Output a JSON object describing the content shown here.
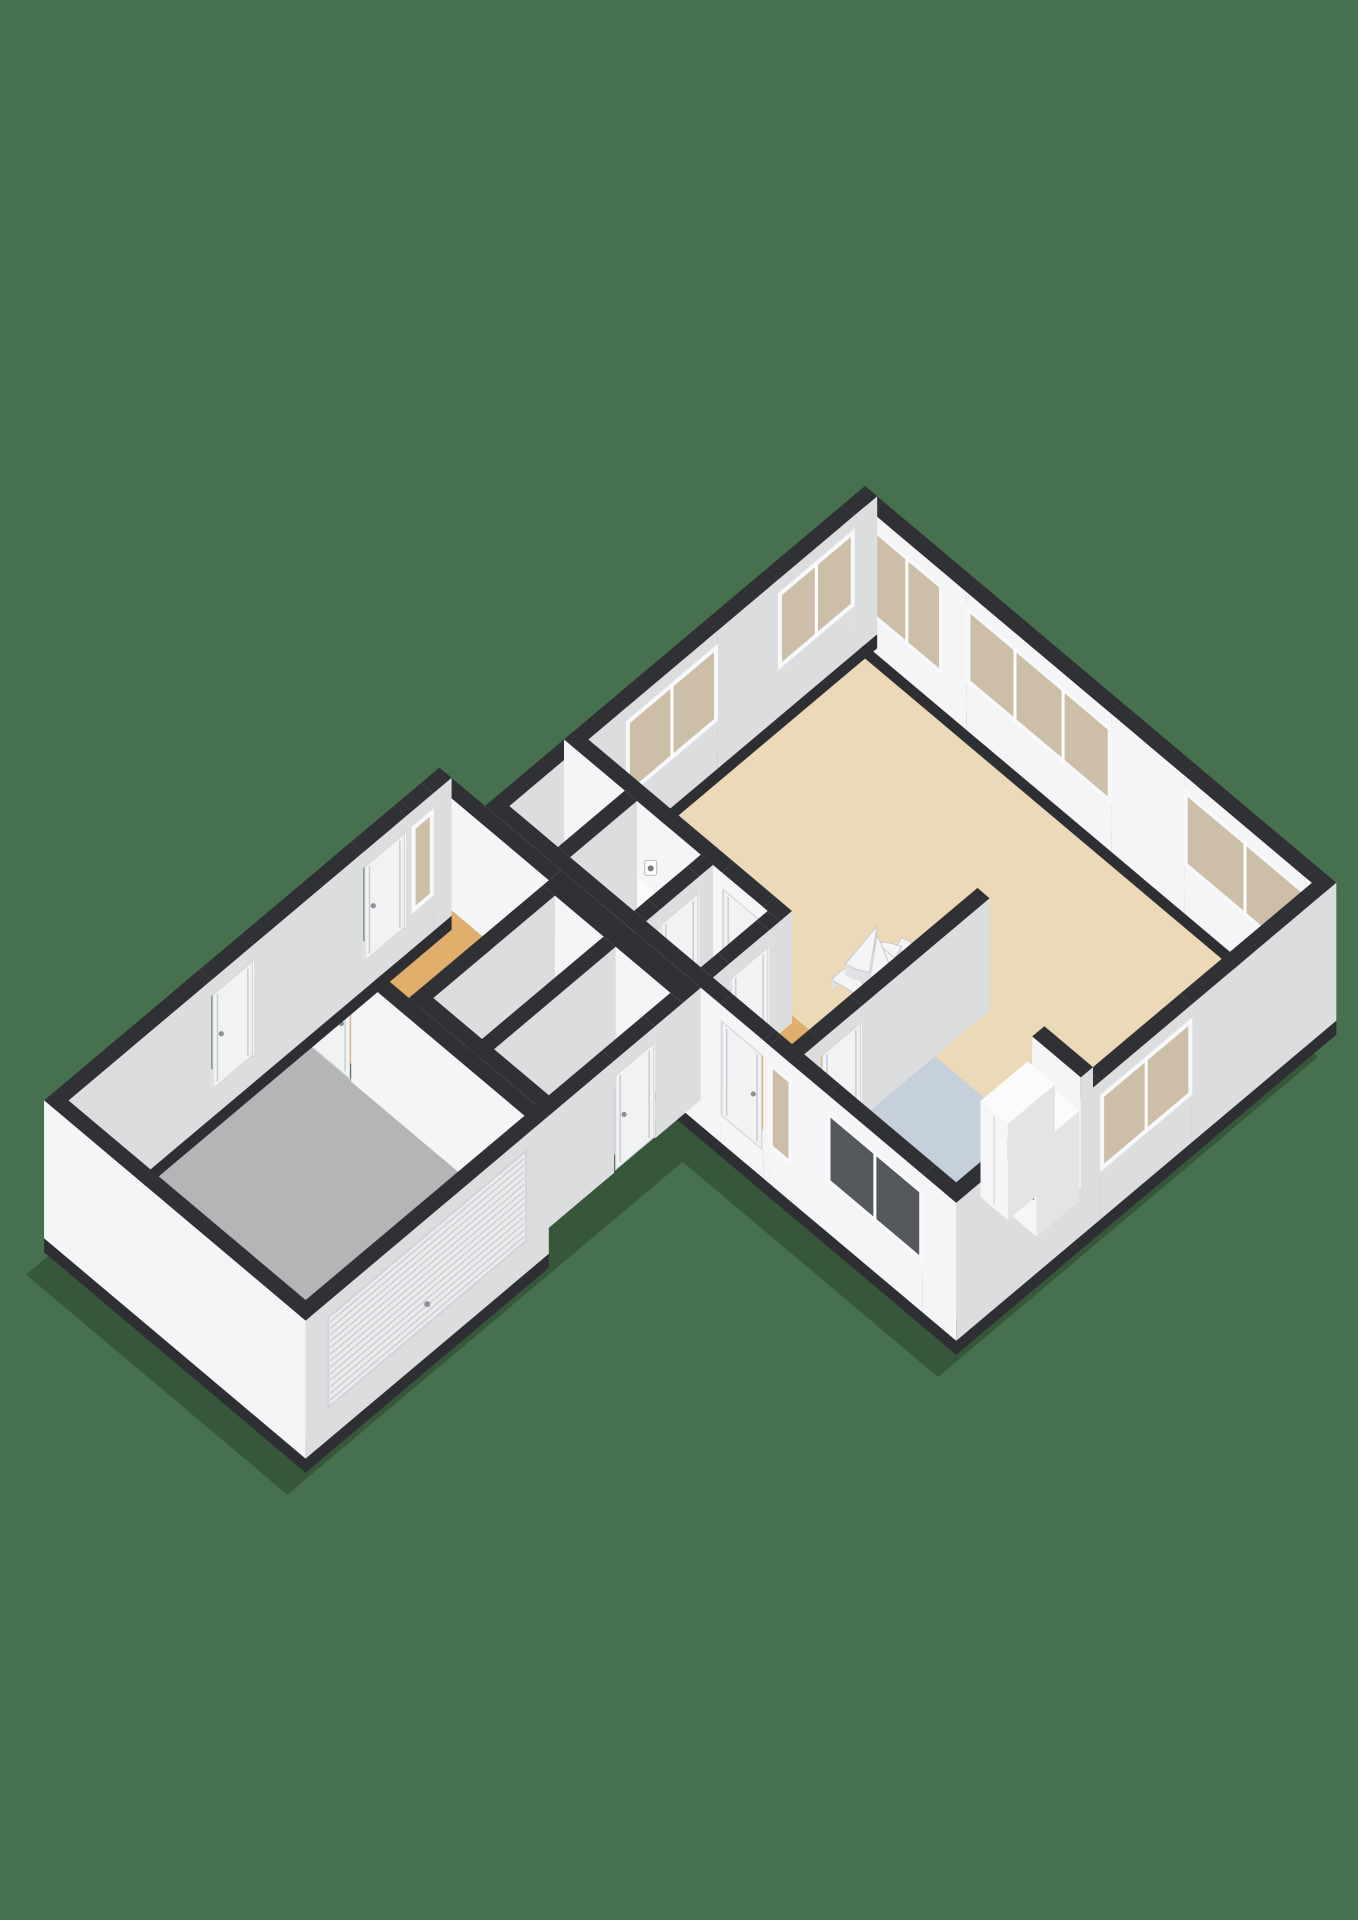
{
  "scene": {
    "title": "3d-floorplan-ground-floor",
    "background": "#47704E",
    "canvas": {
      "width": 1358,
      "height": 1920
    },
    "projection": {
      "ax": 0.76,
      "ay": 0.64,
      "ox": 865,
      "oy": 598,
      "wallHeight": 112,
      "extBase": -26,
      "plinthBase": -40
    },
    "colors": {
      "wallTop": "#303134",
      "faceV": "#F5F5F7",
      "faceU": "#DCDDDF",
      "plinth": "#2E2F33",
      "sillTop": "#E8E9EB",
      "glassTan": "#CDBFA7",
      "glassDark": "#55585D",
      "frame": "#F7F8FA",
      "leaf": "#F1F2F4",
      "leafSeam": "#C8C9CC",
      "handle": "#8E9094",
      "rollerFill": "#E9EAEC",
      "rollerLine": "#C6C7CA",
      "stepFill": "#F4F4F6",
      "stepEdge": "#C9CACD",
      "riser": "#E0E1E4",
      "boxTop": "#FBFBFC",
      "boxFaceV": "#F6F6F8",
      "boxFaceU": "#E3E4E6",
      "darkNiche": "#3A3C40",
      "socket": "#777B80",
      "shadow": "rgba(15,30,18,0.30)"
    },
    "floors": [
      {
        "name": "floor-living-room",
        "rect": [
          10,
          10,
          610,
          388
        ],
        "color": "#EBD9B7"
      },
      {
        "name": "floor-kitchen",
        "rect": [
          396,
          312,
          612,
          492
        ],
        "color": "#C6D0DC"
      },
      {
        "name": "floor-hall-lower",
        "rect": [
          10,
          374,
          396,
          498
        ],
        "color": "#E1AF6C"
      },
      {
        "name": "floor-boiler-room",
        "rect": [
          96,
          396,
          180,
          486
        ],
        "color": "#CDCED0"
      },
      {
        "name": "floor-utility-room",
        "rect": [
          196,
          396,
          268,
          486
        ],
        "color": "#CDCED0"
      },
      {
        "name": "floor-entry-hall",
        "rect": [
          -48,
          514,
          104,
          702
        ],
        "color": "#E1AF6C"
      },
      {
        "name": "floor-storage-room",
        "rect": [
          114,
          522,
          182,
          688
        ],
        "color": "#CDCED0"
      },
      {
        "name": "floor-toilet-room",
        "rect": [
          194,
          522,
          270,
          688
        ],
        "color": "#CDCED0"
      },
      {
        "name": "floor-garage",
        "rect": [
          -46,
          714,
          272,
          1008
        ],
        "color": "#B4B5B7"
      }
    ],
    "walls": [
      {
        "name": "wall-ne-living",
        "rect": [
          0,
          0,
          620,
          16
        ],
        "ext": true,
        "features": [
          {
            "type": "window",
            "a": 24,
            "b": 118,
            "sill": 8,
            "head": 98,
            "panes": 2,
            "glass": "tan"
          },
          {
            "type": "window",
            "a": 150,
            "b": 340,
            "sill": 22,
            "head": 98,
            "panes": 3,
            "glass": "tan"
          },
          {
            "type": "window",
            "a": 436,
            "b": 596,
            "sill": 22,
            "head": 98,
            "panes": 2,
            "glass": "tan"
          }
        ]
      },
      {
        "name": "wall-nw-living",
        "rect": [
          0,
          0,
          16,
          500
        ],
        "ext": true,
        "features": [
          {
            "type": "window",
            "a": 30,
            "b": 130,
            "sill": 22,
            "head": 98,
            "panes": 2,
            "glass": "tan"
          },
          {
            "type": "window",
            "a": 210,
            "b": 330,
            "sill": 22,
            "head": 98,
            "panes": 2,
            "glass": "tan"
          }
        ]
      },
      {
        "name": "wall-east-end",
        "rect": [
          604,
          0,
          620,
          500
        ],
        "ext": true,
        "features": [
          {
            "type": "window",
            "a": 190,
            "b": 310,
            "sill": 22,
            "head": 98,
            "panes": 2,
            "glass": "tan"
          }
        ]
      },
      {
        "name": "wall-kitchen-ne",
        "rect": [
          540,
          304,
          604,
          320
        ],
        "features": []
      },
      {
        "name": "wall-stair-kitchen-west",
        "rect": [
          388,
          240,
          404,
          500
        ],
        "features": [
          {
            "type": "door",
            "a": 408,
            "b": 462
          }
        ]
      },
      {
        "name": "wall-living-hall",
        "rect": [
          0,
          380,
          284,
          396
        ],
        "features": [
          {
            "type": "socket",
            "a": 114,
            "z": 56
          },
          {
            "type": "door",
            "a": 208,
            "b": 262
          }
        ]
      },
      {
        "name": "wall-boiler-west",
        "rect": [
          80,
          396,
          96,
          484
        ],
        "features": []
      },
      {
        "name": "wall-boiler-mid",
        "rect": [
          180,
          396,
          196,
          484
        ],
        "features": [
          {
            "type": "door",
            "a": 414,
            "b": 466
          }
        ]
      },
      {
        "name": "wall-utility-east",
        "rect": [
          268,
          396,
          284,
          484
        ],
        "features": [
          {
            "type": "door",
            "a": 410,
            "b": 462
          }
        ]
      },
      {
        "name": "wall-se-main",
        "rect": [
          0,
          484,
          620,
          500
        ],
        "ext": true,
        "features": [
          {
            "type": "door",
            "a": 310,
            "b": 366
          },
          {
            "type": "window",
            "a": 374,
            "b": 404,
            "sill": 10,
            "head": 96,
            "panes": 1,
            "glass": "tan"
          },
          {
            "type": "window",
            "a": 450,
            "b": 576,
            "sill": 24,
            "head": 96,
            "panes": 2,
            "glass": "dark"
          }
        ]
      },
      {
        "name": "wall-annex-ne",
        "rect": [
          -60,
          500,
          100,
          516
        ],
        "features": []
      },
      {
        "name": "wall-rooms-ne",
        "rect": [
          100,
          500,
          284,
          524
        ],
        "features": []
      },
      {
        "name": "wall-rooms-nw",
        "rect": [
          100,
          524,
          116,
          700
        ],
        "features": []
      },
      {
        "name": "wall-rooms-mid",
        "rect": [
          180,
          524,
          196,
          700
        ],
        "features": []
      },
      {
        "name": "wall-rooms-east",
        "rect": [
          268,
          524,
          284,
          700
        ],
        "features": [
          {
            "type": "door",
            "a": 560,
            "b": 614
          }
        ]
      },
      {
        "name": "wall-rooms-se",
        "rect": [
          100,
          684,
          284,
          700
        ],
        "features": []
      },
      {
        "name": "wall-garage-ne",
        "rect": [
          -44,
          700,
          284,
          716
        ],
        "features": [
          {
            "type": "door",
            "a": -16,
            "b": 40
          }
        ]
      },
      {
        "name": "wall-annex-nw",
        "rect": [
          -60,
          500,
          -44,
          1020
        ],
        "ext": true,
        "features": [
          {
            "type": "window",
            "a": 524,
            "b": 552,
            "sill": 10,
            "head": 96,
            "panes": 1,
            "glass": "tan"
          },
          {
            "type": "door",
            "a": 560,
            "b": 616
          },
          {
            "type": "door",
            "a": 760,
            "b": 816
          }
        ]
      },
      {
        "name": "wall-garage-sw",
        "rect": [
          268,
          700,
          284,
          1020
        ],
        "ext": true,
        "features": [
          {
            "type": "roller",
            "a": 730,
            "b": 990
          }
        ]
      },
      {
        "name": "wall-annex-se",
        "rect": [
          -60,
          1004,
          284,
          1020
        ],
        "ext": true,
        "features": []
      }
    ],
    "boxes": [
      {
        "name": "kitchen-cabinet-tall",
        "rect": [
          544,
          330,
          580,
          392
        ],
        "h": 96,
        "seamV": 562
      },
      {
        "name": "kitchen-cabinet-oven",
        "rect": [
          580,
          330,
          612,
          386
        ],
        "h": 90,
        "niche": {
          "a": 586,
          "b": 608,
          "z0": 34,
          "z1": 60
        }
      },
      {
        "name": "boiler-unit",
        "rect": [
          104,
          404,
          136,
          436
        ],
        "h": 46,
        "slot": true
      },
      {
        "name": "toilet-cistern",
        "rect": [
          148,
          416,
          168,
          428
        ],
        "h": 32
      },
      {
        "name": "toilet-bowl",
        "rect": [
          146,
          428,
          170,
          450
        ],
        "h": 20,
        "seat": true
      },
      {
        "name": "washbasin",
        "rect": [
          200,
          540,
          218,
          562
        ],
        "h": 34
      },
      {
        "name": "toilet2-cistern",
        "rect": [
          206,
          584,
          226,
          596
        ],
        "h": 30
      },
      {
        "name": "toilet2-bowl",
        "rect": [
          204,
          596,
          228,
          618
        ],
        "h": 20,
        "seat": true
      }
    ],
    "stairs": {
      "name": "spiral-staircase",
      "center": [
        332,
        316
      ],
      "radius": 52,
      "steps": 10,
      "angleStart": 170,
      "angleEnd": 440,
      "zBase": 6,
      "rise": 9
    },
    "shadowHull": [
      [
        0,
        0
      ],
      [
        620,
        0
      ],
      [
        620,
        500
      ],
      [
        284,
        500
      ],
      [
        284,
        1020
      ],
      [
        -60,
        1020
      ],
      [
        -60,
        500
      ],
      [
        0,
        500
      ]
    ]
  }
}
